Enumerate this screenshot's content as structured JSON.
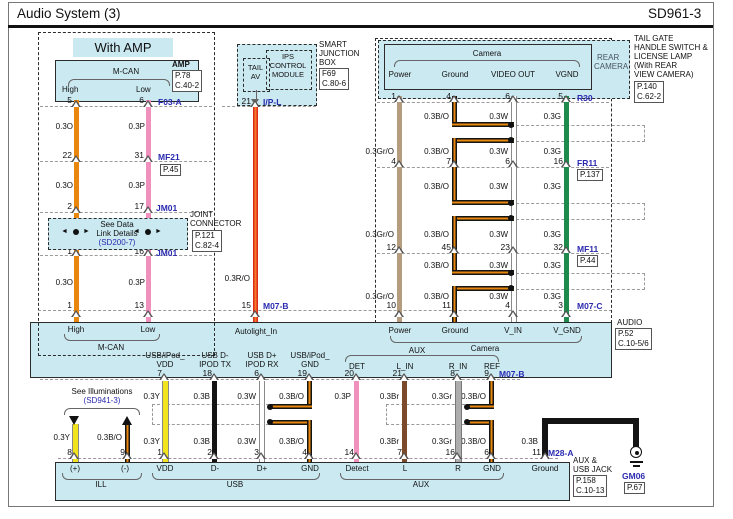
{
  "header": {
    "title": "Audio System (3)",
    "code": "SD961-3"
  },
  "colors": {
    "panel": "#CBE9F1",
    "orange": "#E8860D",
    "pink": "#F090BC",
    "red": "#DD2B1C",
    "tan": "#B59C7F",
    "green": "#1E8B4C",
    "yellow": "#F2E41C",
    "black": "#141414",
    "brown": "#7B4A2A",
    "gray": "#ADADAD",
    "connector_blue": "#2a2ab0"
  },
  "with_amp": {
    "section_label": "With AMP",
    "mcan": {
      "title": "M-CAN",
      "high": "High",
      "low": "Low"
    },
    "amp": {
      "name": "AMP",
      "ref1": "P.78",
      "ref2": "C.40-2"
    },
    "wire_labels": [
      "0.3O",
      "0.3P"
    ],
    "rows": {
      "f03a": {
        "pins": [
          "5",
          "6"
        ],
        "conn": "F03-A"
      },
      "mf21": {
        "pins": [
          "22",
          "31"
        ],
        "conn": "MF21",
        "ref": "P.45"
      },
      "jm01_top": {
        "pins": [
          "2",
          "17"
        ],
        "conn": "JM01"
      },
      "jm01_bot": {
        "pins": [
          "1",
          "16"
        ],
        "conn": "JM01"
      },
      "audio_in": {
        "pins": [
          "1",
          "13"
        ]
      }
    },
    "joint": {
      "line1": "See Data",
      "line2": "Link Details",
      "line3": "(SD200-7)",
      "name1": "JOINT",
      "name2": "CONNECTOR",
      "ref1": "P.121",
      "ref2": "C.82-4"
    }
  },
  "sjb": {
    "module": {
      "l1": "IPS",
      "l2": "CONTROL",
      "l3": "MODULE",
      "tail1": "TAIL",
      "tail2": "AV"
    },
    "name": {
      "l1": "SMART",
      "l2": "JUNCTION",
      "l3": "BOX",
      "ref1": "F69",
      "ref2": "C.80-6"
    },
    "pin_top": "21",
    "conn_top": "I/P-L",
    "wire": "0.3R/O",
    "pin_bot": "15",
    "conn_bot": "M07-B"
  },
  "camera": {
    "box": {
      "title": "Camera",
      "pins": [
        "Power",
        "Ground",
        "VIDEO OUT",
        "VGND"
      ]
    },
    "rear": {
      "l1": "REAR",
      "l2": "CAMERA"
    },
    "tailgate": {
      "l1": "TAIL GATE",
      "l2": "HANDLE SWITCH &",
      "l3": "LICENSE LAMP",
      "l4": "(With REAR",
      "l5": "VIEW CAMERA)",
      "ref1": "P.140",
      "ref2": "C.62-2"
    },
    "rows": {
      "r30": {
        "pins": [
          "1",
          "4",
          "6",
          "5"
        ],
        "conn": "R30"
      },
      "fr11": {
        "pins": [
          "4",
          "7",
          "6",
          "16"
        ],
        "conn": "FR11",
        "ref": "P.137"
      },
      "mf11": {
        "pins": [
          "12",
          "45",
          "23",
          "32"
        ],
        "conn": "MF11",
        "ref": "P.44"
      },
      "m07c": {
        "pins": [
          "10",
          "11",
          "4",
          "3"
        ],
        "conn": "M07-C"
      }
    },
    "seg_short": [
      "0.3B/O",
      "0.3W",
      "0.3G"
    ],
    "seg_full": [
      "0.3Gr/O",
      "0.3B/O",
      "0.3W",
      "0.3G"
    ]
  },
  "audio": {
    "name": "AUDIO",
    "ref1": "P.52",
    "ref2": "C.10-5/6",
    "autolight": "Autolight_In",
    "mcan": {
      "high": "High",
      "low": "Low",
      "label": "M-CAN"
    },
    "camera_grp": {
      "pins": [
        "Power",
        "Ground",
        "V_IN",
        "V_GND"
      ],
      "label": "Camera"
    },
    "usb_grp": {
      "p1a": "USB/iPod_",
      "p1b": "VDD",
      "p2a": "USB D-",
      "p2b": "IPOD TX",
      "p3a": "USB D+",
      "p3b": "IPOD RX",
      "p4a": "USB/iPod_",
      "p4b": "GND"
    },
    "aux_grp": {
      "label": "AUX",
      "pins": [
        "DET",
        "L_IN",
        "R_IN",
        "REF"
      ]
    }
  },
  "bottom": {
    "see_ill": {
      "l1": "See Illuminations",
      "l2": "(SD941-3)"
    },
    "upper_pins": [
      "7",
      "18",
      "6",
      "19",
      "20",
      "21",
      "8",
      "9"
    ],
    "upper_conn": "M07-B",
    "upper_labels": [
      "0.3Y",
      "0.3B",
      "0.3W",
      "0.3B/O",
      "0.3P",
      "0.3Br",
      "0.3Gr",
      "0.3B/O"
    ],
    "ill_labels": [
      "0.3Y",
      "0.3B/O"
    ],
    "lower_labels": [
      "0.3Y",
      "0.3B",
      "0.3W",
      "0.3B/O",
      "0.3Br",
      "0.3Gr",
      "0.3B/O",
      "0.3B"
    ],
    "lower_pins": [
      "8",
      "9",
      "1",
      "2",
      "3",
      "4",
      "14",
      "7",
      "16",
      "6",
      "11"
    ],
    "lower_conn": "M28-A",
    "jack": {
      "pins": [
        "(+)",
        "(-)",
        "VDD",
        "D-",
        "D+",
        "GND",
        "Detect",
        "L",
        "R",
        "GND",
        "Ground"
      ],
      "grp_ill": "ILL",
      "grp_usb": "USB",
      "grp_aux": "AUX",
      "name1": "AUX &",
      "name2": "USB JACK",
      "ref1": "P.158",
      "ref2": "C.10-13"
    },
    "ground": {
      "conn": "GM06",
      "ref": "P.67"
    }
  }
}
